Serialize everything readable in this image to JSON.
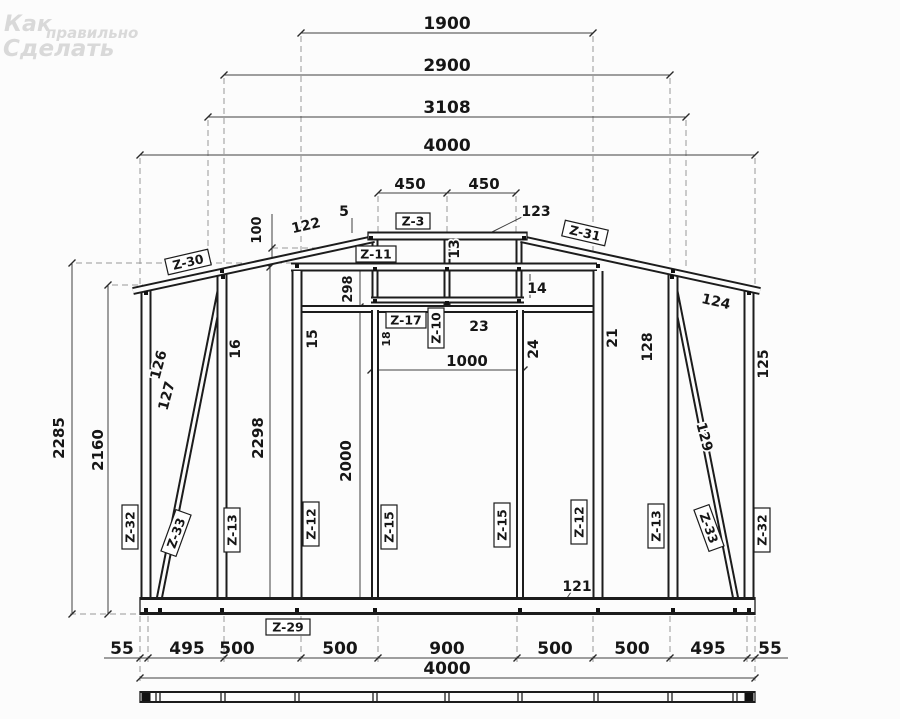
{
  "watermark": {
    "word1": "Как",
    "word2": "правильно",
    "word3": "Сделать"
  },
  "dimensions": {
    "top": {
      "span1": "1900",
      "span2": "2900",
      "span3": "3108",
      "total": "4000"
    },
    "ridge": {
      "left": "450",
      "right": "450",
      "offset": "100",
      "rise": "298"
    },
    "left": {
      "height_plate": "2285",
      "height_eave": "2160",
      "height_wall": "2298",
      "height_opening": "2000"
    },
    "opening": {
      "width": "1000"
    },
    "bottom": {
      "seg1": "55",
      "seg2": "495",
      "seg3": "500",
      "seg4": "500",
      "seg5": "900",
      "seg6": "500",
      "seg7": "500",
      "seg8": "495",
      "seg9": "55",
      "total": "4000"
    }
  },
  "part_numbers": {
    "p5": "5",
    "p13": "13",
    "p14": "14",
    "p15": "15",
    "p16": "16",
    "p18": "18",
    "p21": "21",
    "p23": "23",
    "p24": "24",
    "p121": "121",
    "p122": "122",
    "p123": "123",
    "p124": "124",
    "p125": "125",
    "p126": "126",
    "p127": "127",
    "p128": "128",
    "p129": "129"
  },
  "assembly_labels": {
    "z3": "Z-3",
    "z10": "Z-10",
    "z11": "Z-11",
    "z12": "Z-12",
    "z13": "Z-13",
    "z15": "Z-15",
    "z17": "Z-17",
    "z29": "Z-29",
    "z30": "Z-30",
    "z31": "Z-31",
    "z32": "Z-32",
    "z33": "Z-33"
  },
  "colors": {
    "line": "#1c1c1c",
    "dim": "#3f3f3f",
    "dashed": "#979797",
    "watermark": "#d9d9d9",
    "background": "#fcfcfc"
  }
}
